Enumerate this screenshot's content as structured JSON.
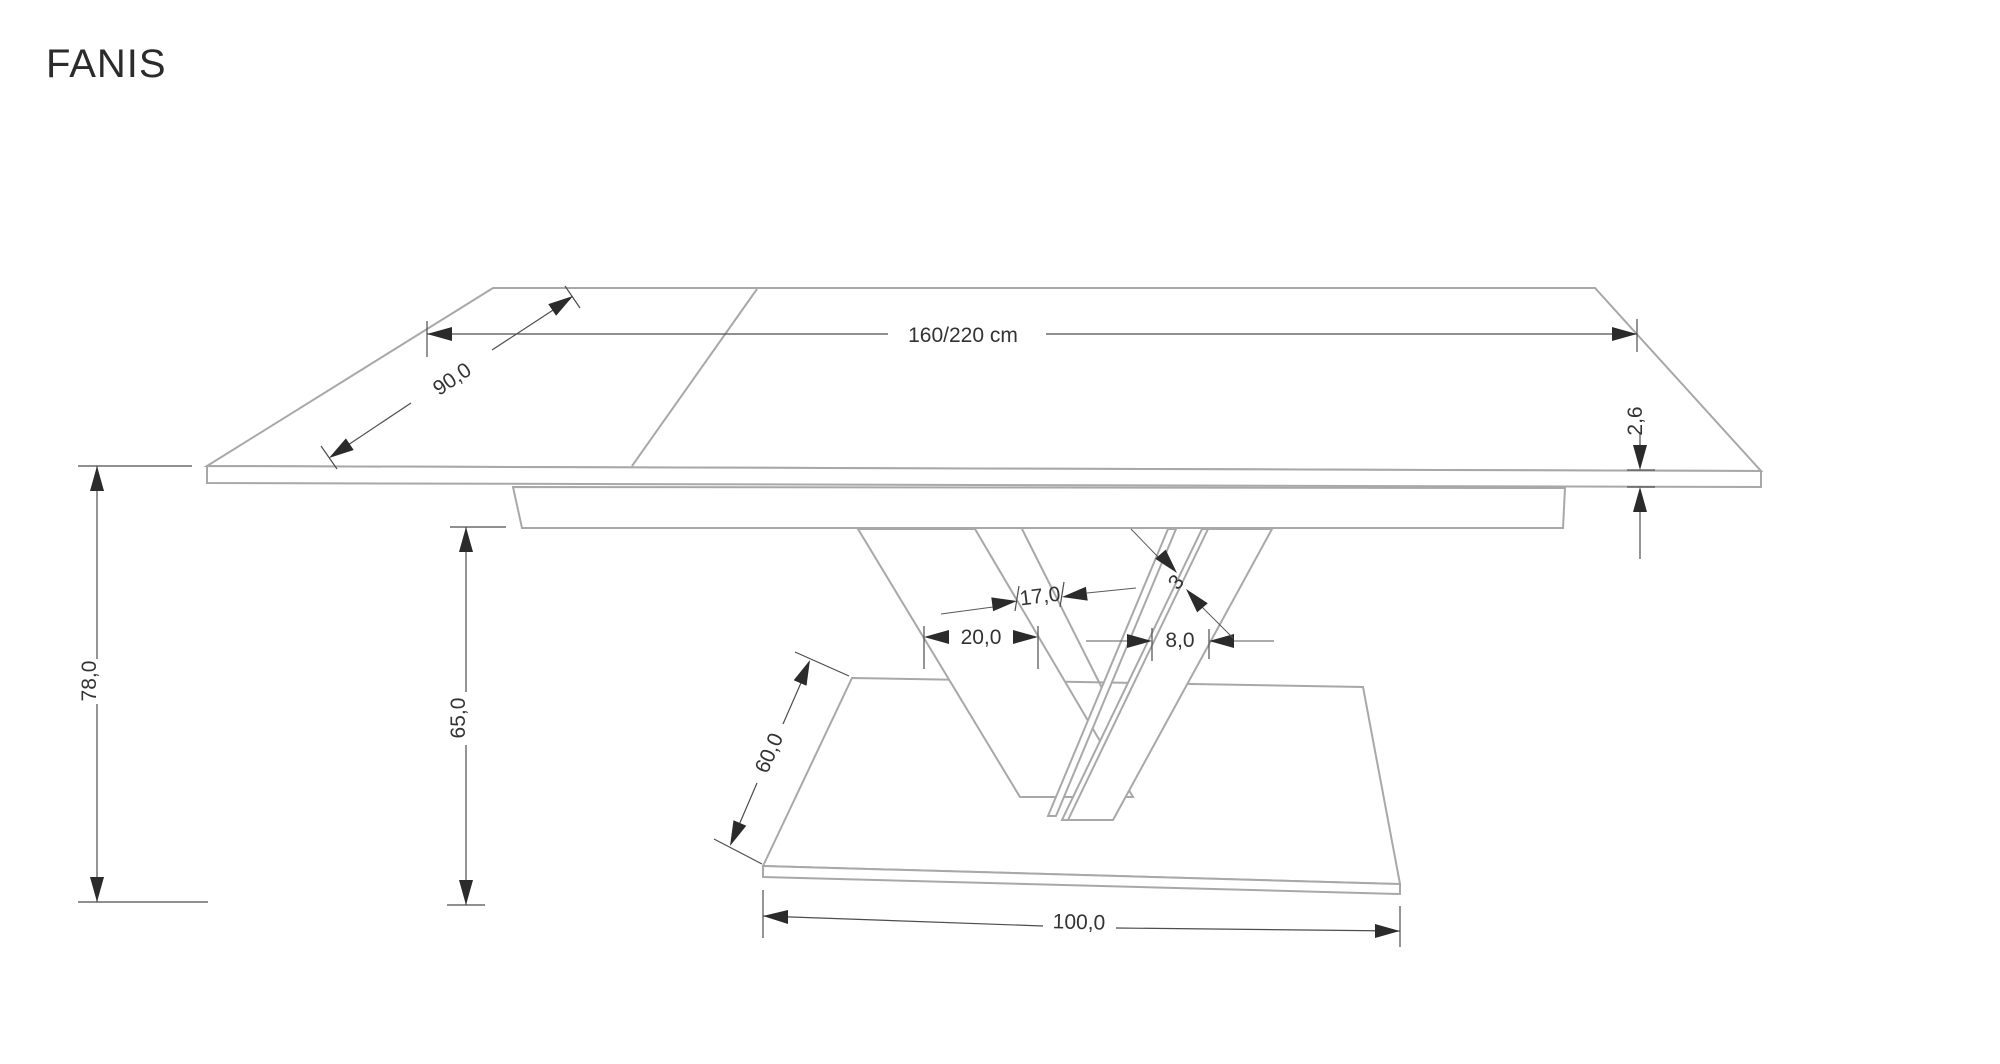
{
  "title": "FANIS",
  "dimensions": {
    "length": "160/220 cm",
    "depth": "90,0",
    "top_thickness": "2,6",
    "total_height": "78,0",
    "pedestal_height": "65,0",
    "leg_front_width": "20,0",
    "leg_gap": "17,0",
    "leg_side_width": "8,0",
    "panel_thickness": "3",
    "base_depth": "60,0",
    "base_length": "100,0"
  },
  "colors": {
    "background": "#ffffff",
    "furniture_outline": "#a8a8a8",
    "dimension_line": "#4d4d4d",
    "label_text": "#333333",
    "arrowhead": "#2b2b2b"
  }
}
